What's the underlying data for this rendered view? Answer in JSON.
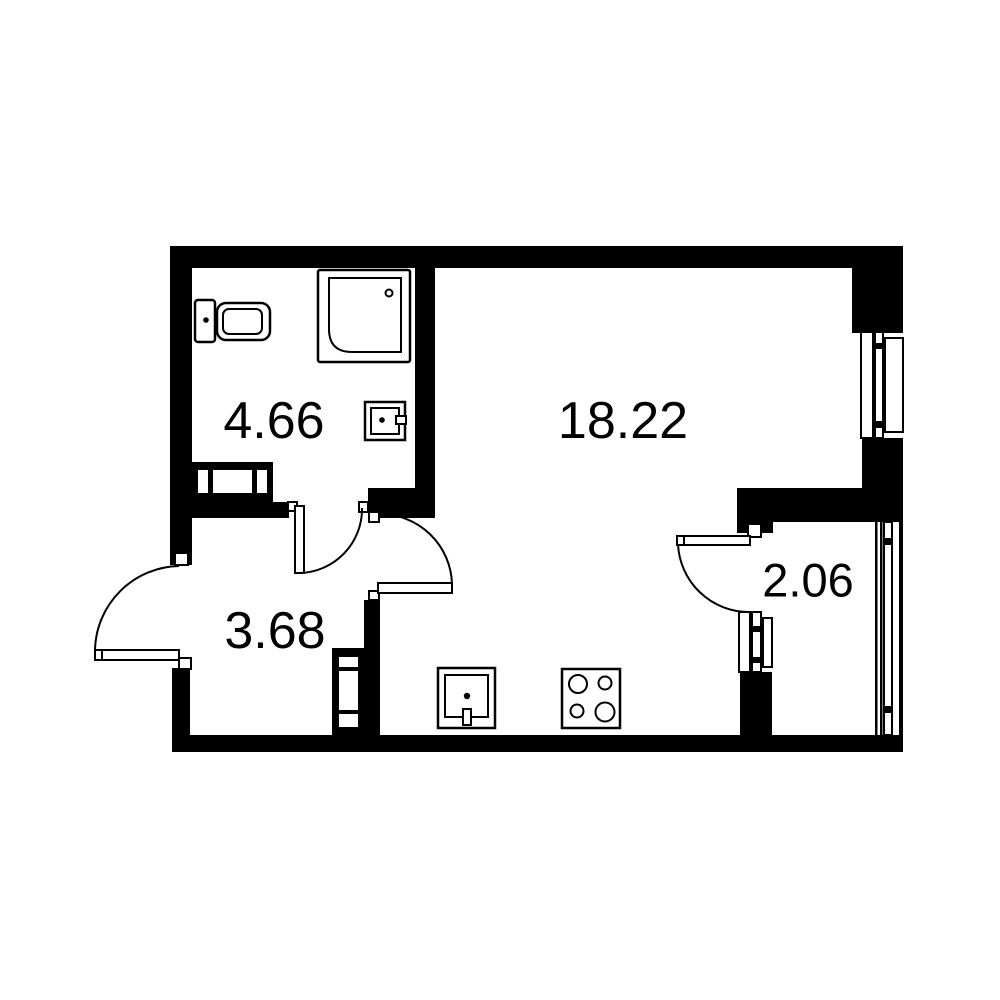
{
  "plan": {
    "background_color": "#ffffff",
    "wall_color": "#000000",
    "line_color": "#000000",
    "rooms": [
      {
        "name": "bathroom",
        "area_label": "4.66"
      },
      {
        "name": "living-room",
        "area_label": "18.22"
      },
      {
        "name": "hallway",
        "area_label": "3.68"
      },
      {
        "name": "balcony",
        "area_label": "2.06"
      }
    ],
    "fixtures": [
      "shower",
      "toilet",
      "washbasin",
      "radiator",
      "kitchen-sink",
      "stove",
      "window",
      "door"
    ]
  }
}
